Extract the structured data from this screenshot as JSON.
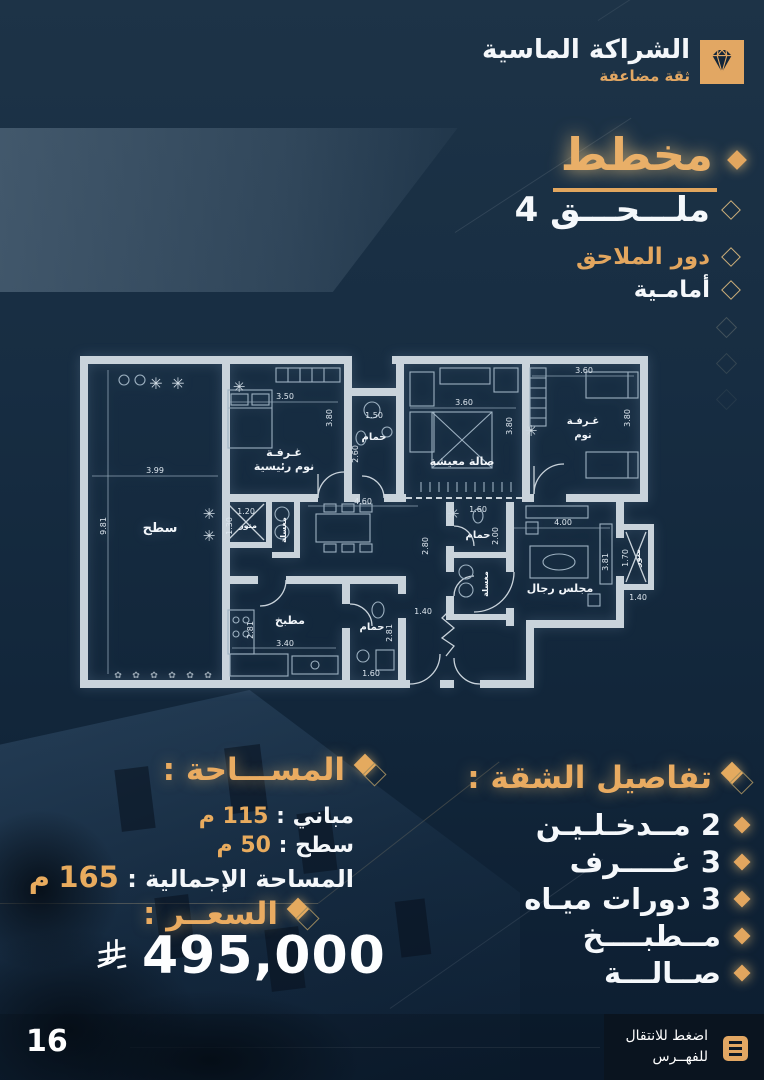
{
  "header": {
    "title": "الشراكة الماسية",
    "subtitle": "ثقة مضاعفة"
  },
  "side": {
    "title": "مخطط",
    "items": [
      {
        "label": "ملـــحـــق 4"
      },
      {
        "label": "دور الملاحق"
      },
      {
        "label": "أمامـية"
      }
    ]
  },
  "floor_plan": {
    "flower": "✳",
    "plant": "✿",
    "room_labels": [
      "سطح",
      "غـرفـة",
      "نوم رئيسية",
      "حمام",
      "صالة معيشة",
      "غـرفـة",
      "نوم",
      "منور",
      "مغسلة",
      "حمام",
      "مغسلة",
      "مجلس رجال",
      "منور",
      "مطبخ",
      "حمام"
    ],
    "dims": [
      "3.99",
      "9.81",
      "3.50",
      "3.80",
      "1.50",
      "2.60",
      "3.60",
      "3.80",
      "3.60",
      "3.80",
      "1.20",
      "1.30",
      "4.60",
      "2.80",
      "1.60",
      "2.00",
      "4.00",
      "3.81",
      "1.70",
      "1.40",
      "3.40",
      "2.81",
      "2.81",
      "1.60",
      "1.40"
    ]
  },
  "area": {
    "title": "المســـاحة :",
    "lines": [
      {
        "label": "مباني :",
        "value": "115",
        "unit": "م"
      },
      {
        "label": "سطح :",
        "value": "50",
        "unit": "م"
      },
      {
        "label": "المساحة الإجمالية :",
        "value": "165",
        "unit": "م"
      }
    ]
  },
  "price": {
    "title": "السعــر :",
    "value": "495,000"
  },
  "details": {
    "title": "تفاصيل الشقة :",
    "items": [
      "2 مــدخـلـيـن",
      "3 غـــــرف",
      "3 دورات ميـاه",
      "مــطبــــخ",
      "صــالـــة"
    ]
  },
  "footer": {
    "page": "16",
    "cta_line1": "اضغط للانتقال",
    "cta_line2": "للفهــرس"
  },
  "colors": {
    "gold": "#e2a65f",
    "navy": "#152a3e",
    "wall": "#c9d3db",
    "footer_dark": "#0a141f"
  }
}
